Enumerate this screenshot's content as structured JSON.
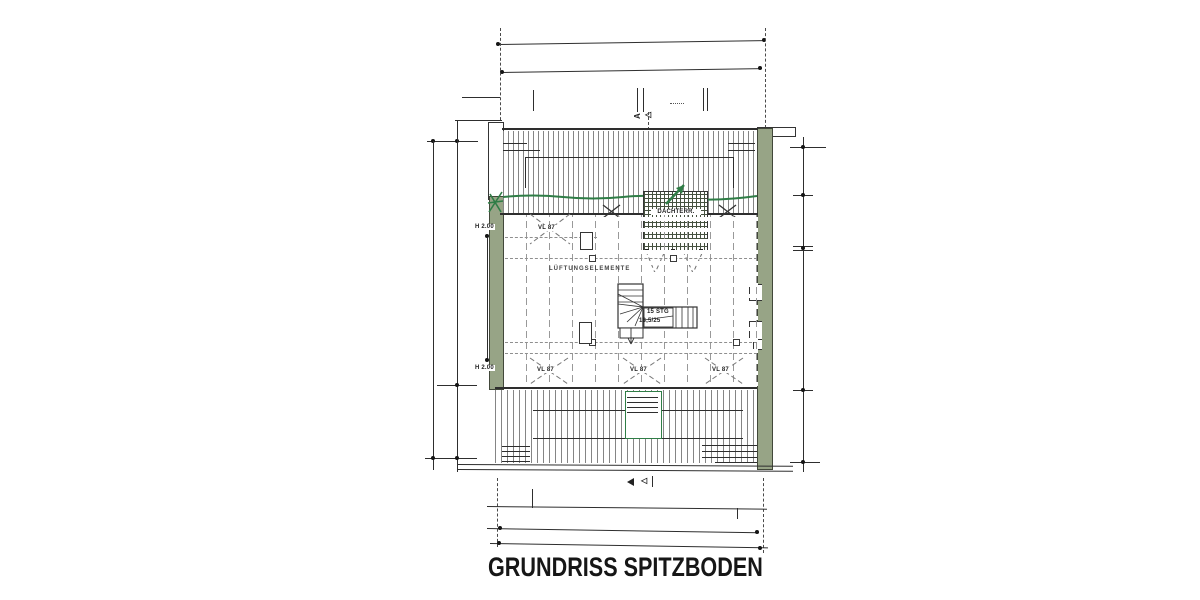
{
  "drawing": {
    "title": "GRUNDRISS SPITZBODEN",
    "terrace_label": "DACHTERR.",
    "vent_note": "LÜFTUNGSELEMENTE",
    "stair": {
      "line1": "15 STG",
      "line2": "18,5/25"
    },
    "height_marks": {
      "top": "H 2.00",
      "bottom": "H 2.00"
    },
    "skylight_labels": {
      "top_left": "VL 87",
      "bottom_left": "VL 87",
      "bottom_center": "VL 87",
      "bottom_right": "VL 87"
    },
    "section_marker": {
      "letter": "A",
      "arrow_filled": "◀",
      "arrow_outline": "◁"
    },
    "colors": {
      "ink": "#2e2e2e",
      "hatch": "#858585",
      "wall_green": "#97a486",
      "marker_green": "#2f7d46"
    }
  }
}
